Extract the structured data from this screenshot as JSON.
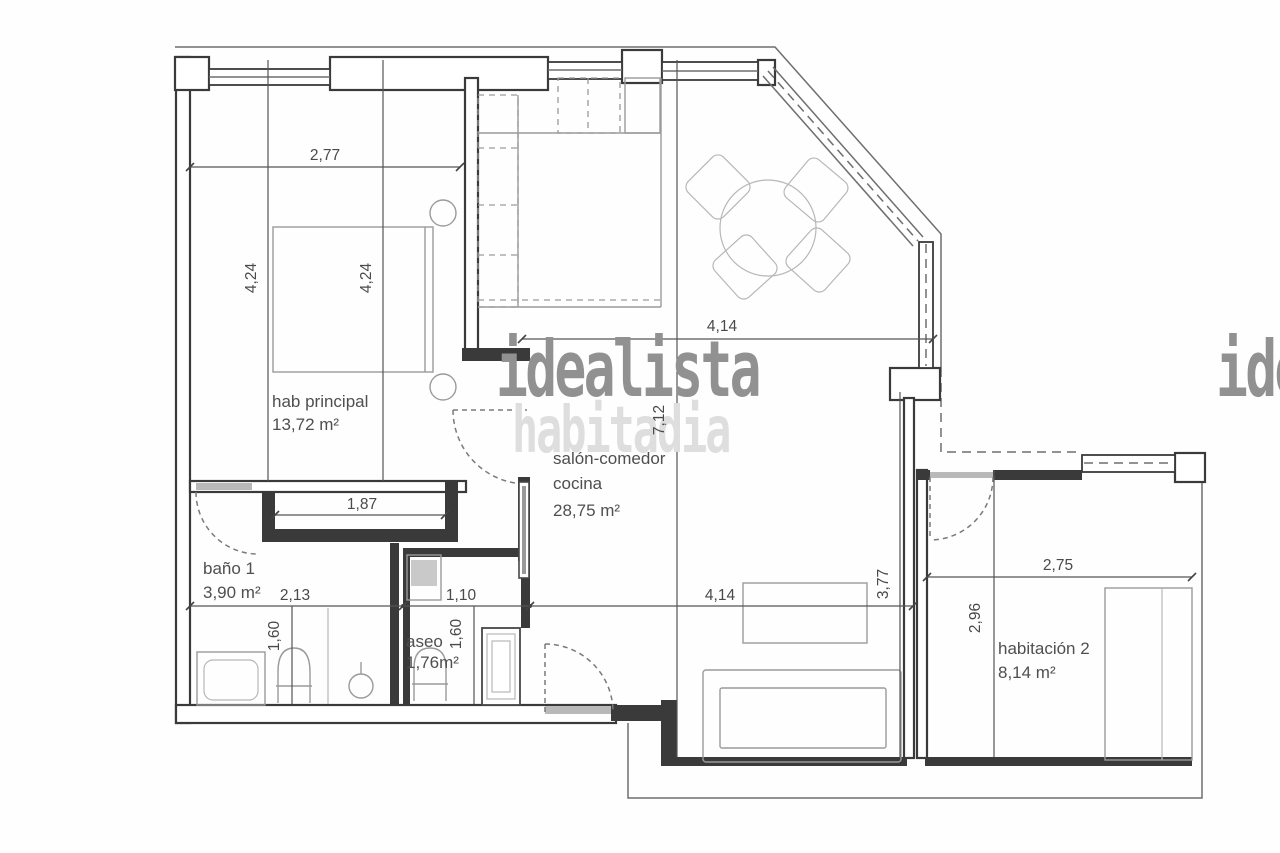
{
  "watermark": {
    "primary": "idealista",
    "secondary": "habitadia"
  },
  "rooms": {
    "hab_principal": {
      "name": "hab principal",
      "area": "13,72 m²"
    },
    "salon": {
      "line1": "salón-comedor",
      "line2": "cocina",
      "area": "28,75 m²"
    },
    "bano1": {
      "name": "baño 1",
      "area": "3,90 m²"
    },
    "aseo": {
      "name": "aseo",
      "area": "1,76m²"
    },
    "habitacion2": {
      "name": "habitación 2",
      "area": "8,14 m²"
    }
  },
  "dims": {
    "hab_width": "2,77",
    "hab_height_a": "4,24",
    "hab_height_b": "4,24",
    "wardrobe_width": "1,87",
    "bano_width": "2,13",
    "bano_depth": "1,60",
    "aseo_width": "1,10",
    "aseo_depth": "1,60",
    "salon_width_top": "4,14",
    "salon_length": "7,12",
    "salon_width_bottom": "4,14",
    "salon_right_height": "3,77",
    "hab2_width": "2,75",
    "hab2_height": "2,96"
  },
  "colors": {
    "wall": "#3a3a3a",
    "furniture": "#9a9a9a",
    "watermark_dark": "#919191",
    "watermark_light": "#dedede",
    "background": "#fefefe"
  }
}
